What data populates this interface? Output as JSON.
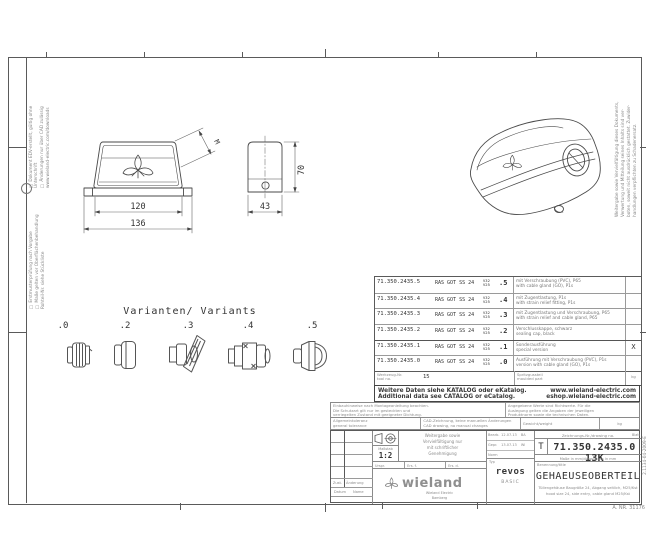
{
  "border_notes": {
    "left_top_lines": [
      "□ Dokument EDV-erstellt, gültig ohne Unterschrift",
      "□ Änderungen nur über CAD zulässig",
      "www.wieland-electric.com/downloads"
    ],
    "left_bottom_lines": [
      "□ Erstmusterprüfung nach Vorgabe",
      "□ Maße gelten vor Oberflächenbehandlung",
      "Rohteil-Nr. siehe Stückliste"
    ],
    "right_vertical_lines": [
      "Weitergabe sowie Vervielfältigung dieses Dokuments,",
      "Verwertung und Mitteilung seines Inhalts sind ver-",
      "boten, soweit nicht ausdrücklich gestattet. Zuwider-",
      "handlungen verpflichten zu Schadenersatz."
    ],
    "right_code": "2.1134-04-2009-E",
    "corner_note": "A. NR. 31176"
  },
  "views": {
    "front": {
      "dim_inner": "120",
      "dim_outer": "136",
      "dim_angled": "M"
    },
    "side": {
      "dim_width": "43",
      "dim_height": "70"
    }
  },
  "variants": {
    "title": "Varianten/ Variants",
    "labels": [
      ".0",
      ".2",
      ".3",
      ".4",
      ".5"
    ]
  },
  "table": {
    "rows": [
      {
        "part": "71.350.2435.5",
        "type": "RAS GOT SS 24",
        "size1": "V32",
        "size2": "V25",
        "suffix": ".5",
        "desc_de": "mit Verschraubung (PVC), P65",
        "desc_en": "with cable gland (GO), P1s",
        "mark": ""
      },
      {
        "part": "71.350.2435.4",
        "type": "RAS GOT SS 24",
        "size1": "V32",
        "size2": "V25",
        "suffix": ".4",
        "desc_de": "mit Zugentlastung, P1s",
        "desc_en": "with strain relief fitting, P1s",
        "mark": ""
      },
      {
        "part": "71.350.2435.3",
        "type": "RAS GOT SS 24",
        "size1": "V32",
        "size2": "V25",
        "suffix": ".3",
        "desc_de": "mit Zugentlastung und Verschraubung, P65",
        "desc_en": "with strain relief and cable gland, P65",
        "mark": ""
      },
      {
        "part": "71.350.2435.2",
        "type": "RAS GOT SS 24",
        "size1": "V32",
        "size2": "V25",
        "suffix": ".2",
        "desc_de": "Verschlusskappe, schwarz",
        "desc_en": "sealing cap, black",
        "mark": ""
      },
      {
        "part": "71.350.2435.1",
        "type": "RAS GOT SS 24",
        "size1": "V32",
        "size2": "V25",
        "suffix": ".1",
        "desc_de": "Sonderausführung",
        "desc_en": "special version",
        "mark": "X"
      },
      {
        "part": "71.350.2435.0",
        "type": "RAS GOT SS 24",
        "size1": "V32",
        "size2": "V25",
        "suffix": ".0",
        "desc_de": "Ausführung mit Verschraubung (PVC), P1s",
        "desc_en": "version with cable gland (GO), P1s",
        "mark": ""
      }
    ],
    "footer": {
      "c1_de": "Werkzeug-Nr.",
      "c1_en": "tool no.",
      "c2": "15",
      "c3_de": "Spritzgussteil",
      "c3_en": "moulded part",
      "c4": "kg"
    }
  },
  "catalog": {
    "de": "Weitere Daten siehe KATALOG oder eKatalog.",
    "en": "Additional data see CATALOG or eCatalog.",
    "url1": "www.wieland-electric.com",
    "url2": "eshop.wieland-electric.com"
  },
  "fine_print": {
    "left": [
      "Einbauhinweise nach Montageanleitung beachten.",
      "Die Schutzart gilt nur im gesteckten und",
      "verriegelten Zustand mit geeigneter Dichtung."
    ],
    "right": [
      "Angegebene Werte sind Richtwerte. Für die",
      "Auslegung gelten die Angaben der jeweiligen",
      "Produktnorm sowie die technischen Daten."
    ]
  },
  "general_row": {
    "a_de": "Allgemeintoleranz",
    "a_en": "general tolerance",
    "b_de": "CAD-Zeichnung, keine manuellen Änderungen",
    "b_en": "CAD drawing, no manual changes",
    "c": "Gewicht/weight",
    "d": "kg"
  },
  "title_block": {
    "revision": {
      "h1a": "Zust.",
      "h1b": "Änderung",
      "h2a": "Datum",
      "h2b": "Name"
    },
    "scale_label": "Maßstab",
    "scale": "1:2",
    "protect_lines": [
      "Weitergabe sowie",
      "Vervielfältigung nur",
      "mit schriftlicher",
      "Genehmigung"
    ],
    "origin": [
      "Urspr.",
      "Ers. f.",
      "Ers. d."
    ],
    "logo": {
      "text": "wieland",
      "sub1": "Wieland Electric",
      "sub2": "Bamberg"
    },
    "approvals": [
      {
        "label": "Bearb.",
        "date": "12.07.13",
        "name": "BA"
      },
      {
        "label": "Gepr.",
        "date": "13.07.13",
        "name": "Wi"
      },
      {
        "label": "Norm",
        "date": "",
        "name": ""
      }
    ],
    "drawing_no": {
      "header": "Zeichnungs-Nr./drawing no.",
      "sheet": "Blatt",
      "t": "T",
      "number": "71.350.2435.0 13K",
      "note": "Maße in mm/dimensions in mm"
    },
    "type_box": {
      "label": "Typ",
      "line1": "revos",
      "line2": "BASIC"
    },
    "title_box": {
      "label": "Benennung/title",
      "title": "GEHAEUSEOBERTEIL",
      "sub1": "Tüllengehäuse Baugröße 24, Abgang seitlich, M25/Kst",
      "sub2": "hood size 24, side entry, cable gland M25/Kst"
    }
  }
}
